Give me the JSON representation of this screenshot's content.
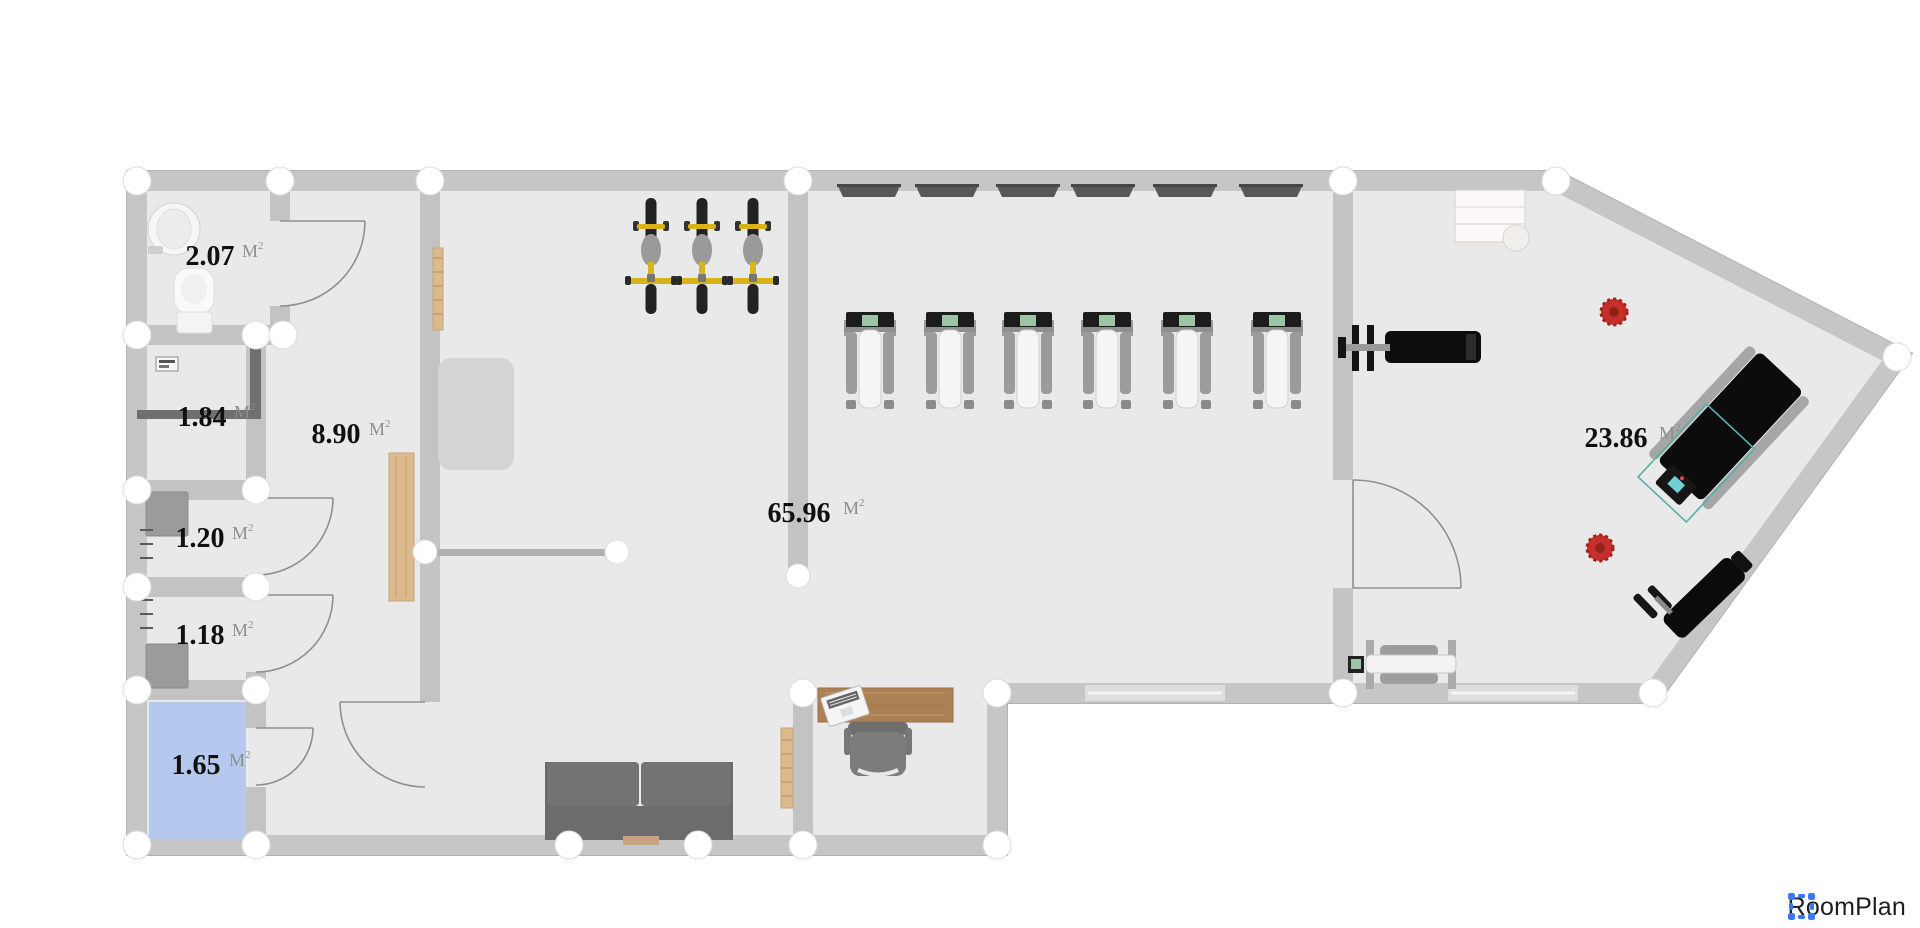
{
  "branding": {
    "app_name": "RoomPlan"
  },
  "floor_plan": {
    "rooms": [
      {
        "id": "bathroom",
        "area": "2.07",
        "unit": "M",
        "unit_sup": "2"
      },
      {
        "id": "laundry",
        "area": "1.84",
        "unit": "M",
        "unit_sup": "2"
      },
      {
        "id": "stall-upper",
        "area": "1.20",
        "unit": "M",
        "unit_sup": "2"
      },
      {
        "id": "stall-lower",
        "area": "1.18",
        "unit": "M",
        "unit_sup": "2"
      },
      {
        "id": "storage-selected",
        "area": "1.65",
        "unit": "M",
        "unit_sup": "2",
        "highlighted": true
      },
      {
        "id": "hallway",
        "area": "8.90",
        "unit": "M",
        "unit_sup": "2"
      },
      {
        "id": "main-gym-floor",
        "area": "65.96",
        "unit": "M",
        "unit_sup": "2"
      },
      {
        "id": "free-weights-wing",
        "area": "23.86",
        "unit": "M",
        "unit_sup": "2"
      }
    ],
    "equipment": [
      {
        "name": "exercise-bike",
        "count": 3
      },
      {
        "name": "treadmill",
        "count": 6
      },
      {
        "name": "wall-tv",
        "count": 6
      },
      {
        "name": "bench-press",
        "count": 1
      },
      {
        "name": "incline-treadmill",
        "count": 1
      },
      {
        "name": "incline-bench",
        "count": 1
      },
      {
        "name": "rowing-machine",
        "count": 1
      },
      {
        "name": "plant",
        "count": 2
      },
      {
        "name": "sofa",
        "count": 1
      },
      {
        "name": "desk-with-laptop",
        "count": 1
      },
      {
        "name": "office-chair",
        "count": 1
      },
      {
        "name": "toilet",
        "count": 1
      },
      {
        "name": "sink",
        "count": 1
      }
    ],
    "colors": {
      "wall": "#c3c3c3",
      "floor": "#e9e9e9",
      "highlight": "#b4c9ed",
      "equipment_yellow": "#d8b31a",
      "plant_red": "#c5302c",
      "wood": "#ab8054",
      "brand_blue": "#3b78f6"
    }
  }
}
